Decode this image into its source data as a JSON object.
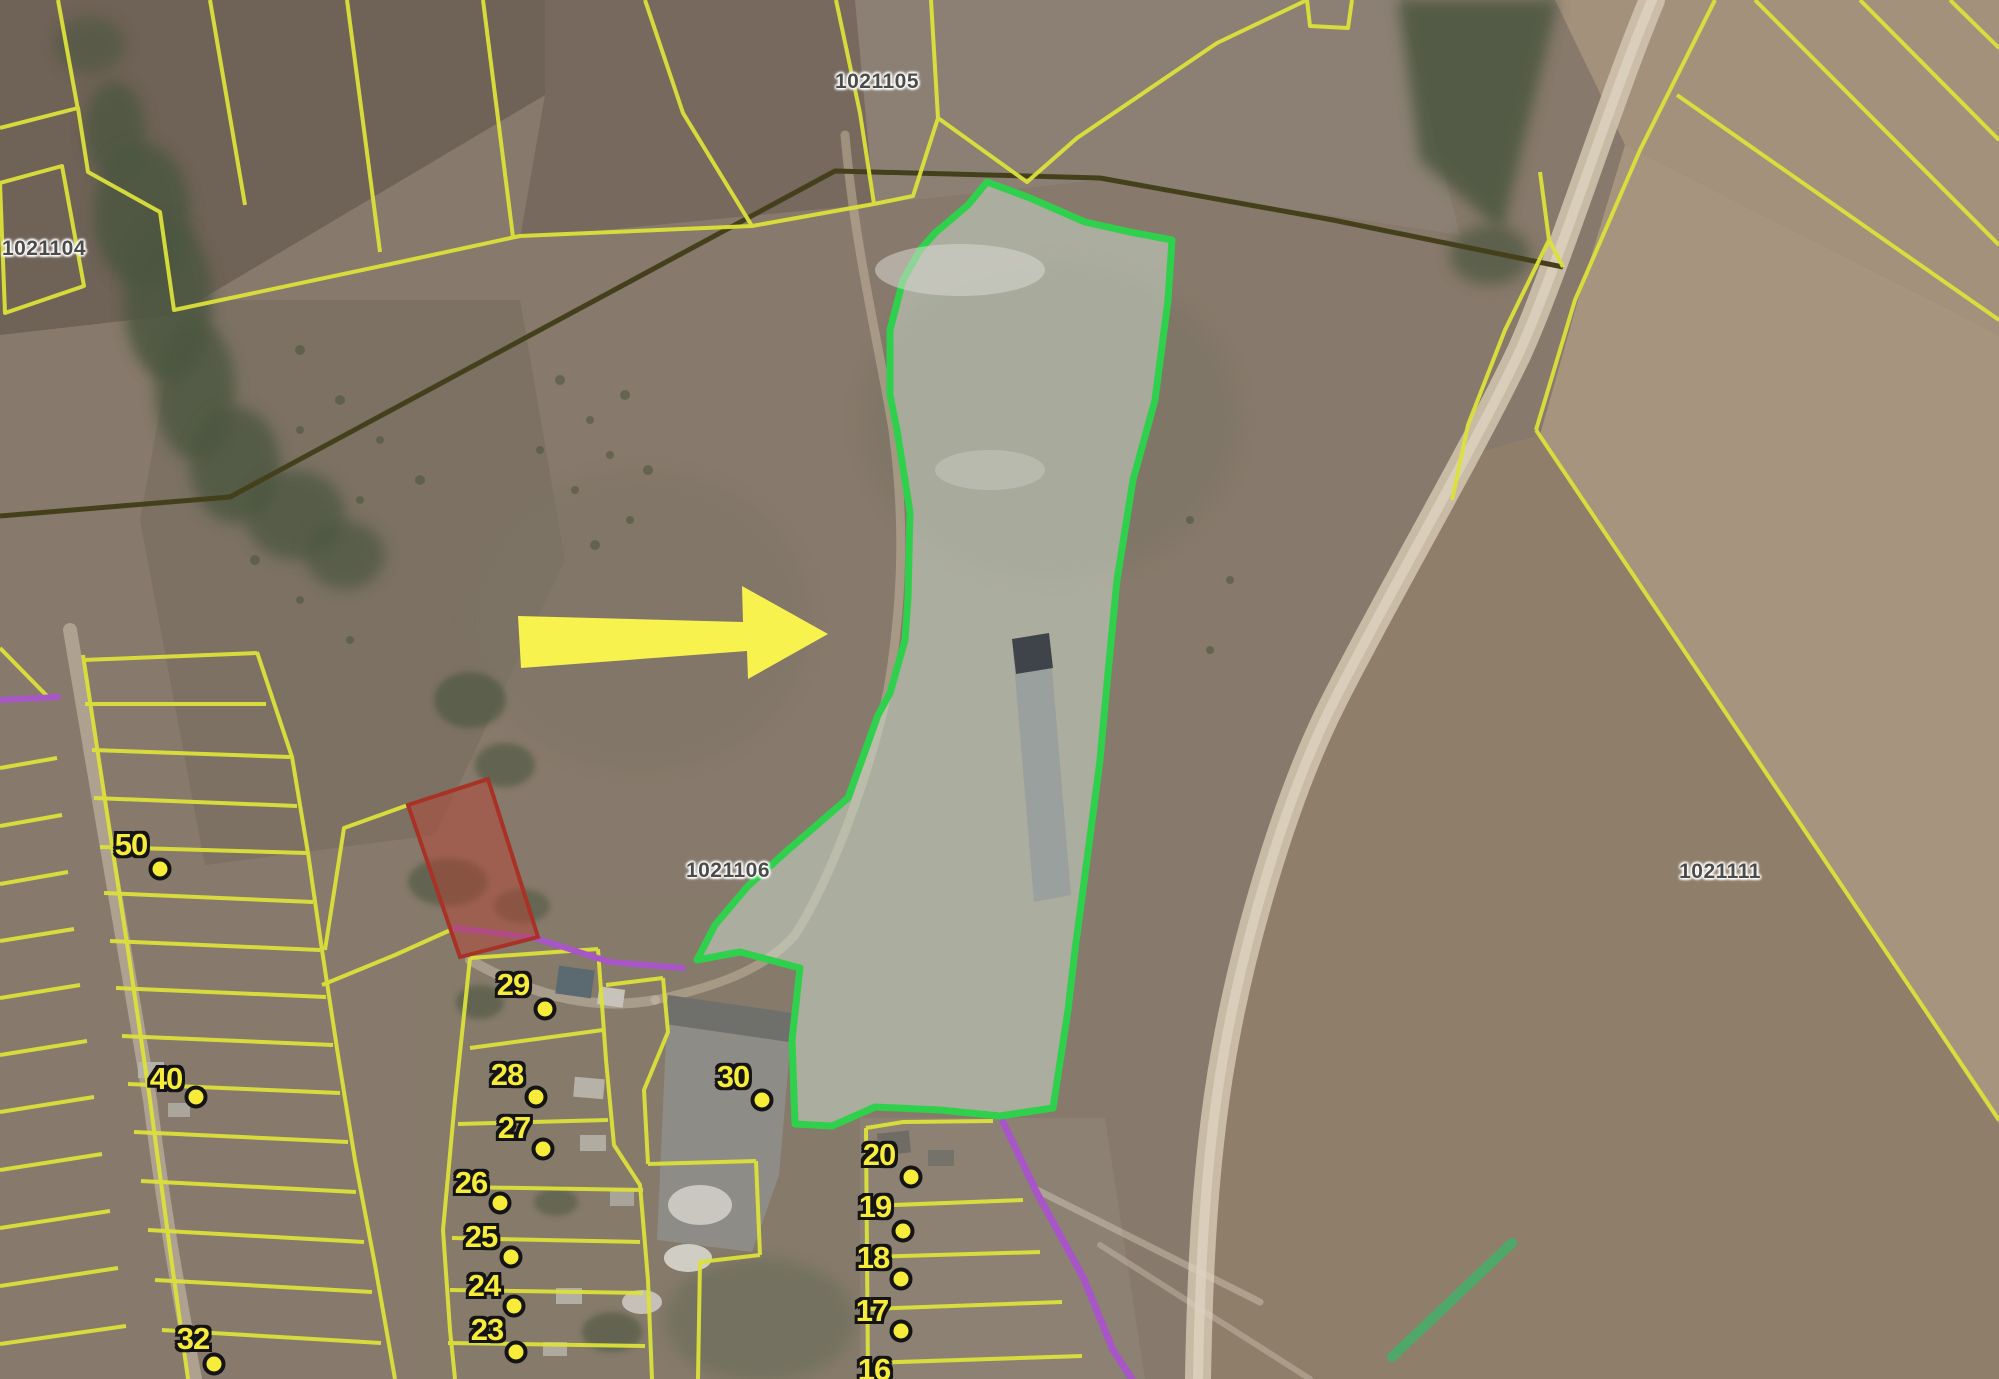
{
  "colors": {
    "parcel_line": "#dce23a",
    "highlight_stroke": "#2fd14c",
    "highlight_fill": "rgba(206,221,206,0.52)",
    "red_stroke": "#a93227",
    "red_fill": "rgba(186,64,48,0.45)",
    "road_purple": "#a855c8",
    "boundary_dark": "#45401c",
    "arrow_yellow": "#f7f24e",
    "marker_yellow": "#f6ec39",
    "green_segment": "#44b06a",
    "label_text": "#4b4b49"
  },
  "parcel_labels": [
    {
      "text": "1021104",
      "x": 44,
      "y": 249
    },
    {
      "text": "1021105",
      "x": 877,
      "y": 82
    },
    {
      "text": "1021106",
      "x": 728,
      "y": 871
    },
    {
      "text": "1021111",
      "x": 1720,
      "y": 872
    }
  ],
  "point_markers": [
    {
      "text": "50",
      "tx": 131,
      "ty": 845,
      "dx": 160,
      "dy": 869
    },
    {
      "text": "40",
      "tx": 166,
      "ty": 1079,
      "dx": 196,
      "dy": 1097
    },
    {
      "text": "32",
      "tx": 193,
      "ty": 1339,
      "dx": 214,
      "dy": 1364
    },
    {
      "text": "29",
      "tx": 513,
      "ty": 985,
      "dx": 545,
      "dy": 1009
    },
    {
      "text": "28",
      "tx": 507,
      "ty": 1075,
      "dx": 536,
      "dy": 1097
    },
    {
      "text": "27",
      "tx": 514,
      "ty": 1128,
      "dx": 543,
      "dy": 1149
    },
    {
      "text": "26",
      "tx": 471,
      "ty": 1183,
      "dx": 500,
      "dy": 1203
    },
    {
      "text": "25",
      "tx": 481,
      "ty": 1237,
      "dx": 511,
      "dy": 1257
    },
    {
      "text": "24",
      "tx": 484,
      "ty": 1286,
      "dx": 514,
      "dy": 1306
    },
    {
      "text": "23",
      "tx": 487,
      "ty": 1330,
      "dx": 516,
      "dy": 1352
    },
    {
      "text": "30",
      "tx": 733,
      "ty": 1077,
      "dx": 762,
      "dy": 1100
    },
    {
      "text": "20",
      "tx": 879,
      "ty": 1155,
      "dx": 911,
      "dy": 1177
    },
    {
      "text": "19",
      "tx": 875,
      "ty": 1207,
      "dx": 903,
      "dy": 1231
    },
    {
      "text": "18",
      "tx": 873,
      "ty": 1258,
      "dx": 901,
      "dy": 1279
    },
    {
      "text": "17",
      "tx": 872,
      "ty": 1311,
      "dx": 901,
      "dy": 1331
    },
    {
      "text": "16",
      "tx": 874,
      "ty": 1370,
      "dx": null,
      "dy": null
    }
  ]
}
